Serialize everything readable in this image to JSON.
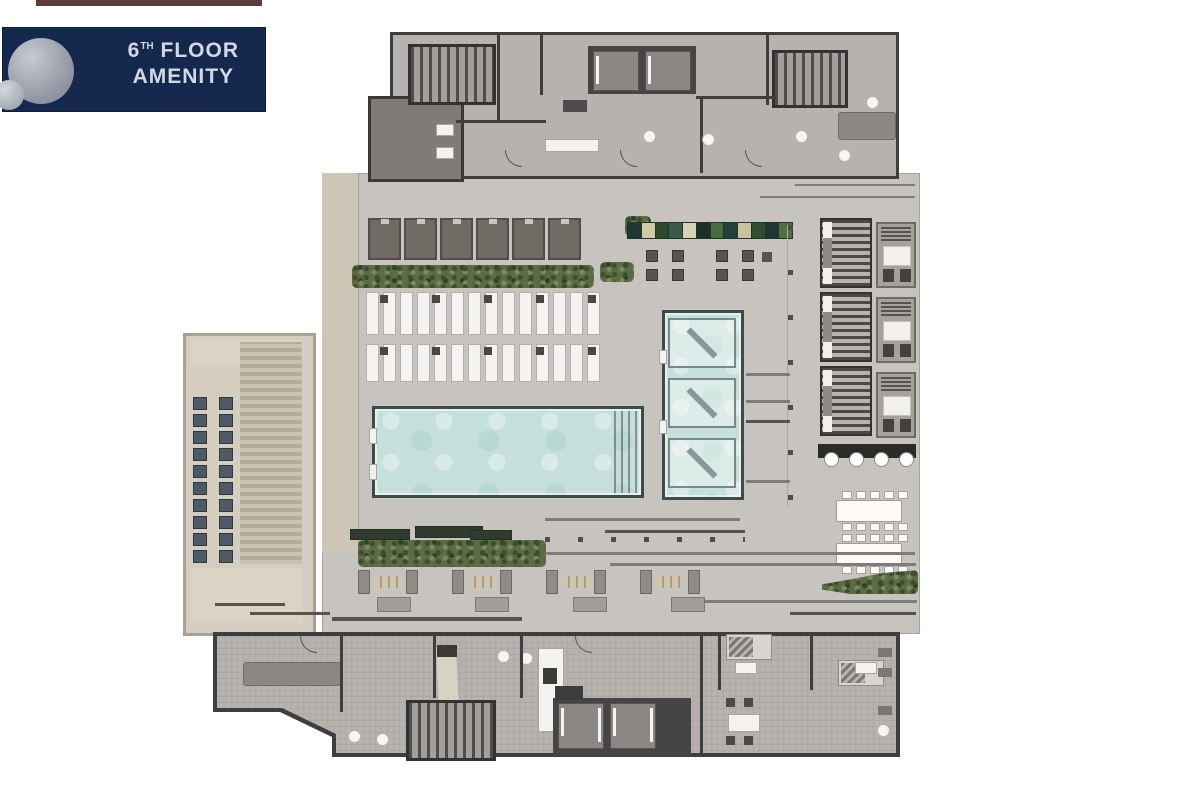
{
  "badge": {
    "floor_number": "6",
    "floor_suffix": "TH",
    "floor_word": "FLOOR",
    "line2": "AMENITY"
  },
  "palette": {
    "badge_navy": "#15294e",
    "badge_text": "#d3d9e4",
    "sphere_gray": "#9ba0ab",
    "top_strip_maroon": "#5a3c38",
    "deck_gray": "#c7c4bf",
    "interior_floor": "#b6b3ae",
    "wall_dark": "#3e3d3f",
    "terrace_beige": "#d5cec0",
    "pool_water": "#c5e0da",
    "cabana_taupe": "#6f6a63",
    "hedge_green": "#5d6b45",
    "lounger_white": "#f4f3f1",
    "theater_seat_slate": "#505a64"
  },
  "plan": {
    "features": {
      "cabanas": 6,
      "loungers_per_row": 14,
      "lounger_rows": 2,
      "lounger_side_tables_per_row": 5,
      "theater_seat_rows": 10,
      "theater_seat_cols": 2,
      "theater_seats": 20,
      "spa_loungers": 3,
      "pavilions": 3,
      "pavilion_rooms": 3,
      "bar_stools": 4,
      "dining_tables": 2,
      "dining_chairs_per_side": 5,
      "seating_groups": 4,
      "benches": 4,
      "elevator_cars": 2,
      "table_cluster_cells": 4
    },
    "planter_blocks": [
      "#1e3b33",
      "#cfc9a6",
      "#2c4a28",
      "#3a5b46",
      "#d6d2b4",
      "#1c2f2a",
      "#4a6b3d",
      "#23413a",
      "#c9c2a0",
      "#2f5030",
      "#1d3830",
      "#50703f"
    ]
  }
}
